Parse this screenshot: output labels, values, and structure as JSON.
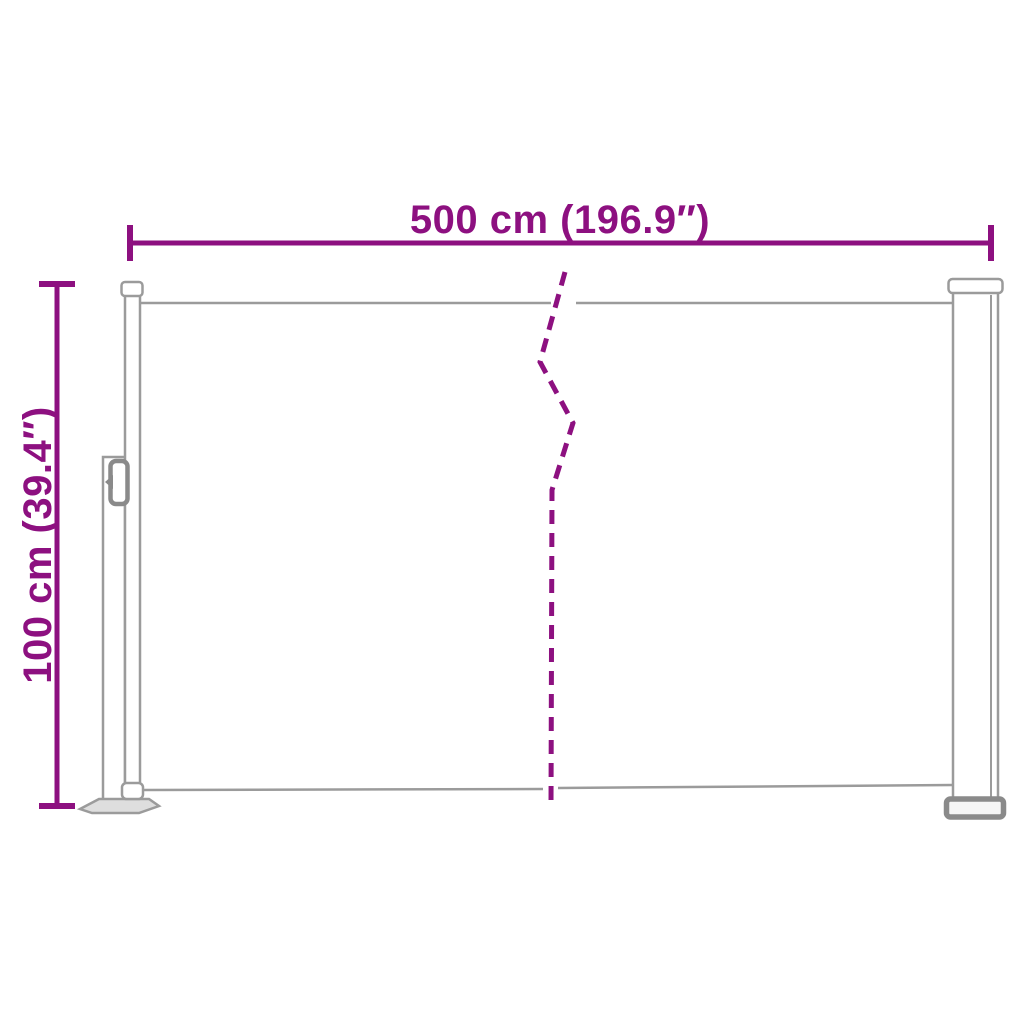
{
  "labels": {
    "width": "500 cm (196.9″)",
    "height": "100 cm (39.4″)"
  },
  "colors": {
    "dimension": "#8d1080",
    "outline": "#9b9b9b",
    "outline_dark": "#8a8a8a",
    "plate_fill": "#dedede",
    "background": "#ffffff"
  }
}
